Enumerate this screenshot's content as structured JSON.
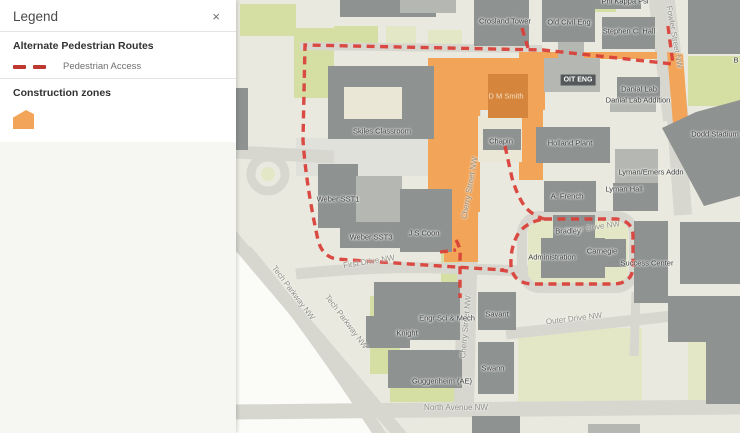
{
  "panel": {
    "title": "Legend",
    "close_icon": "×"
  },
  "legend": {
    "routes_title": "Alternate Pedestrian Routes",
    "routes_item": "Pedestrian Access",
    "construction_title": "Construction zones"
  },
  "colors": {
    "route_red": "#d9413a",
    "legend_red": "#bf3830",
    "construction_orange": "#f2a458",
    "construction_dark": "#d6863c"
  },
  "map": {
    "labels": [
      {
        "text": "Crosland Tower",
        "x": 269,
        "y": 21,
        "cls": "bldg"
      },
      {
        "text": "Old Civil Eng",
        "x": 333,
        "y": 22,
        "cls": "bldg"
      },
      {
        "text": "Stephen C. Hall",
        "x": 393,
        "y": 31,
        "cls": "bldg"
      },
      {
        "text": "Phi Kappa Psi",
        "x": 389,
        "y": 1,
        "cls": "bldg"
      },
      {
        "text": "Fowler Street NW",
        "x": 438,
        "y": 37,
        "rot": 80,
        "cls": "street"
      },
      {
        "text": "B",
        "x": 500,
        "y": 60,
        "cls": "bldg"
      },
      {
        "text": "OIT ENG",
        "x": 342,
        "y": 80,
        "cls": "boxed"
      },
      {
        "text": "Danial Lab",
        "x": 403,
        "y": 89,
        "cls": "bldg"
      },
      {
        "text": "Danial Lab Addition",
        "x": 402,
        "y": 100,
        "cls": "bldg"
      },
      {
        "text": "Dodd Stadium",
        "x": 479,
        "y": 134,
        "cls": "bldg"
      },
      {
        "text": "Skiles Classroom",
        "x": 146,
        "y": 131,
        "cls": "bldg"
      },
      {
        "text": "D M Smith",
        "x": 270,
        "y": 96,
        "cls": "dm"
      },
      {
        "text": "Chapin",
        "x": 265,
        "y": 141,
        "cls": "bldg"
      },
      {
        "text": "Holland Plant",
        "x": 334,
        "y": 143,
        "cls": "bldg"
      },
      {
        "text": "Lyman/Emers Addn",
        "x": 415,
        "y": 172,
        "cls": "bldg"
      },
      {
        "text": "Lyman Hall",
        "x": 388,
        "y": 189,
        "cls": "bldg"
      },
      {
        "text": "A. French",
        "x": 331,
        "y": 196,
        "cls": "bldg"
      },
      {
        "text": "Cherry Street NW",
        "x": 234,
        "y": 188,
        "rot": -80,
        "cls": "street"
      },
      {
        "text": "Weber SST1",
        "x": 102,
        "y": 199,
        "cls": "bldg"
      },
      {
        "text": "Weber SST3",
        "x": 135,
        "y": 237,
        "cls": "bldg"
      },
      {
        "text": "J S Coon",
        "x": 188,
        "y": 233,
        "cls": "bldg"
      },
      {
        "text": "First Drive NW",
        "x": 133,
        "y": 262,
        "rot": -9,
        "cls": "street"
      },
      {
        "text": "Tech Parkway NW",
        "x": 57,
        "y": 293,
        "rot": 53,
        "cls": "street"
      },
      {
        "text": "Tech Parkway NW",
        "x": 110,
        "y": 322,
        "rot": 53,
        "cls": "street"
      },
      {
        "text": "Outer Drive NW",
        "x": 356,
        "y": 228,
        "rot": -8,
        "cls": "street"
      },
      {
        "text": "Bradley",
        "x": 332,
        "y": 231,
        "cls": "bldg"
      },
      {
        "text": "Administration",
        "x": 316,
        "y": 257,
        "cls": "bldg"
      },
      {
        "text": "Carnegie",
        "x": 366,
        "y": 251,
        "cls": "bldg"
      },
      {
        "text": "Success Center",
        "x": 411,
        "y": 263,
        "cls": "bldg"
      },
      {
        "text": "Cherry Street NW",
        "x": 230,
        "y": 327,
        "rot": -85,
        "cls": "street"
      },
      {
        "text": "Engr Sci & Mech",
        "x": 211,
        "y": 318,
        "cls": "bldg"
      },
      {
        "text": "Knight",
        "x": 171,
        "y": 333,
        "cls": "bldg"
      },
      {
        "text": "Savant",
        "x": 261,
        "y": 314,
        "cls": "bldg"
      },
      {
        "text": "Swann",
        "x": 257,
        "y": 368,
        "cls": "bldg"
      },
      {
        "text": "Guggenheim (AE)",
        "x": 206,
        "y": 381,
        "cls": "bldg"
      },
      {
        "text": "Outer Drive NW",
        "x": 338,
        "y": 319,
        "rot": -7,
        "cls": "street"
      },
      {
        "text": "North Avenue NW",
        "x": 220,
        "y": 408,
        "cls": "street"
      }
    ]
  }
}
